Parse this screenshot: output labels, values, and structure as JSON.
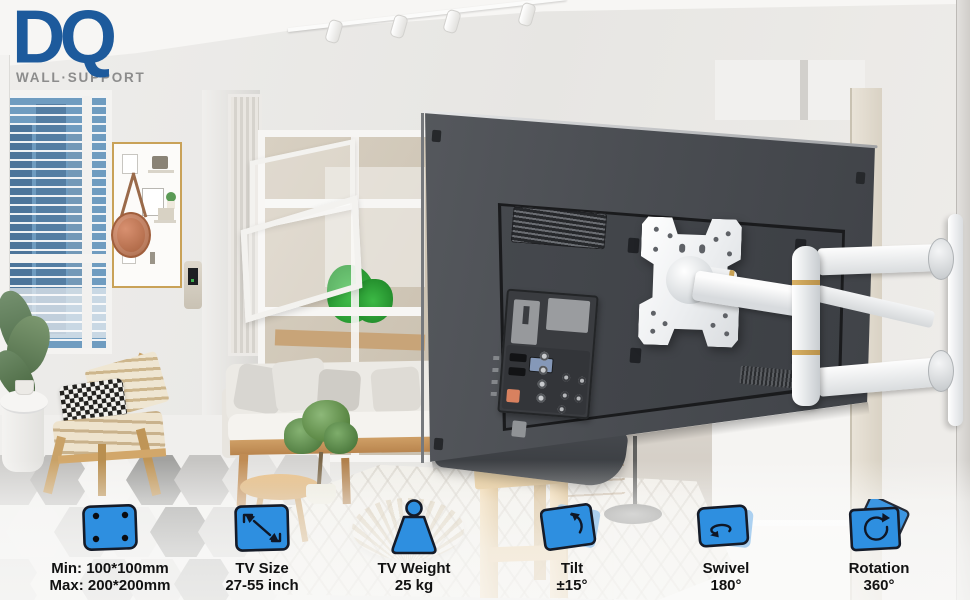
{
  "logo": {
    "brand": "DQ",
    "tagline": "WALL·SUPPORT"
  },
  "specs": [
    {
      "icon": "vesa-pattern-icon",
      "line1": "Min: 100*100mm",
      "line2": "Max: 200*200mm"
    },
    {
      "icon": "tv-size-icon",
      "line1": "TV Size",
      "line2": "27-55 inch"
    },
    {
      "icon": "tv-weight-icon",
      "line1": "TV Weight",
      "line2": "25 kg"
    },
    {
      "icon": "tilt-icon",
      "line1": "Tilt",
      "line2": "±15°"
    },
    {
      "icon": "swivel-icon",
      "line1": "Swivel",
      "line2": "180°"
    },
    {
      "icon": "rotation-icon",
      "line1": "Rotation",
      "line2": "360°"
    }
  ],
  "colors": {
    "accent_blue": "#2E8FE0",
    "icon_back_blue": "#9AC7EE",
    "icon_outline": "#151B28",
    "logo_blue": "#1D5A9C",
    "tagline_grey": "#8C8C8C",
    "label_text": "#121212"
  }
}
